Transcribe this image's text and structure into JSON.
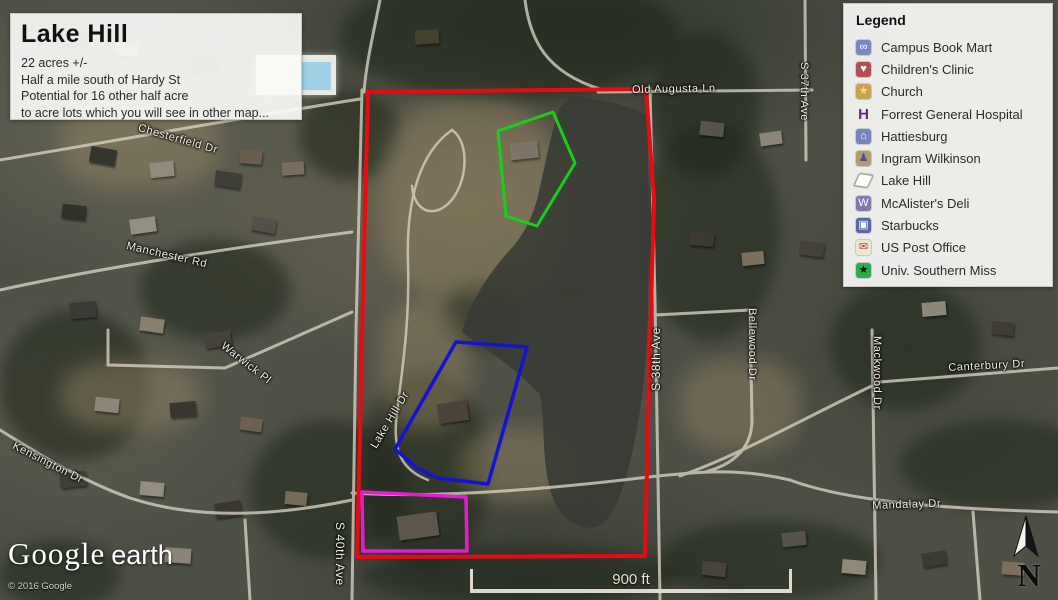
{
  "info_box": {
    "title": "Lake Hill",
    "lines": [
      "22 acres +/-",
      "Half a mile south of Hardy St",
      "Potential for 16 other half acre",
      "to acre lots which you will see in other map..."
    ]
  },
  "legend": {
    "title": "Legend",
    "items": [
      {
        "name": "campus-book-mart",
        "label": "Campus Book Mart",
        "glyph": "∞",
        "bg": "#7B86C2",
        "fg": "#ffffff"
      },
      {
        "name": "childrens-clinic",
        "label": "Children's Clinic",
        "glyph": "♥",
        "bg": "#B0504E",
        "fg": "#ffffff"
      },
      {
        "name": "church",
        "label": "Church",
        "glyph": "★",
        "bg": "#C9A353",
        "fg": "#F5E070"
      },
      {
        "name": "forrest-general-hospital",
        "label": "Forrest General Hospital",
        "glyph": "H",
        "bg": "transparent",
        "fg": "#5B2D84"
      },
      {
        "name": "hattiesburg",
        "label": "Hattiesburg",
        "glyph": "⌂",
        "bg": "#7585BF",
        "fg": "#ffffff"
      },
      {
        "name": "ingram-wilkinson",
        "label": "Ingram Wilkinson",
        "glyph": "♟",
        "bg": "#B59A6E",
        "fg": "#44549A"
      },
      {
        "name": "lake-hill",
        "label": "Lake Hill",
        "glyph": "",
        "bg": "#FFFFFF",
        "fg": "#333333"
      },
      {
        "name": "mcalisters-deli",
        "label": "McAlister's Deli",
        "glyph": "W",
        "bg": "#8678AC",
        "fg": "#ffffff"
      },
      {
        "name": "starbucks",
        "label": "Starbucks",
        "glyph": "▣",
        "bg": "#5A6AA0",
        "fg": "#ffffff"
      },
      {
        "name": "us-post-office",
        "label": "US Post Office",
        "glyph": "✉",
        "bg": "#EDE6D6",
        "fg": "#9A4A3A"
      },
      {
        "name": "univ-southern-miss",
        "label": "Univ. Southern Miss",
        "glyph": "★",
        "bg": "#2FA84F",
        "fg": "#111111"
      }
    ]
  },
  "map": {
    "streets": {
      "chesterfield": "Chesterfield Dr",
      "manchester": "Manchester Rd",
      "warwick": "Warwick Pl",
      "kensington": "Kensington Dr",
      "old_augusta": "Old Augusta Ln",
      "s37": "S 37th Ave",
      "s38": "S 38th Ave",
      "s40": "S 40th Ave",
      "lake_hill_dr": "Lake Hill Dr",
      "bellewood": "Bellewood Dr",
      "mackwood": "Mackwood Dr",
      "canterbury": "Canterbury Dr",
      "mandalay": "Mandalay Dr"
    },
    "overlays": {
      "boundary": {
        "name": "Lake Hill property boundary",
        "color": "#EA0B12",
        "width": "4",
        "points": "368,92 646,89 654,200 649,380 645,556 357,557 360,430 365,210"
      },
      "green_lot": {
        "name": "north lot",
        "color": "#18CE18",
        "width": "3",
        "points": "553,112 498,131 506,216 537,226 575,163"
      },
      "blue_lot": {
        "name": "middle lot",
        "color": "#1512D6",
        "width": "3.5",
        "points": "456,342 527,347 488,484 438,478 417,468 395,449"
      },
      "magenta_lot": {
        "name": "south lot",
        "color": "#E81BD5",
        "width": "3.5",
        "points": "362,492 466,497 467,551 363,551"
      }
    },
    "scale_bar": {
      "label": "900 ft"
    },
    "north_label": "N",
    "credits": {
      "logo_main": "Google",
      "logo_sub": "earth",
      "copyright": "© 2016 Google"
    }
  }
}
